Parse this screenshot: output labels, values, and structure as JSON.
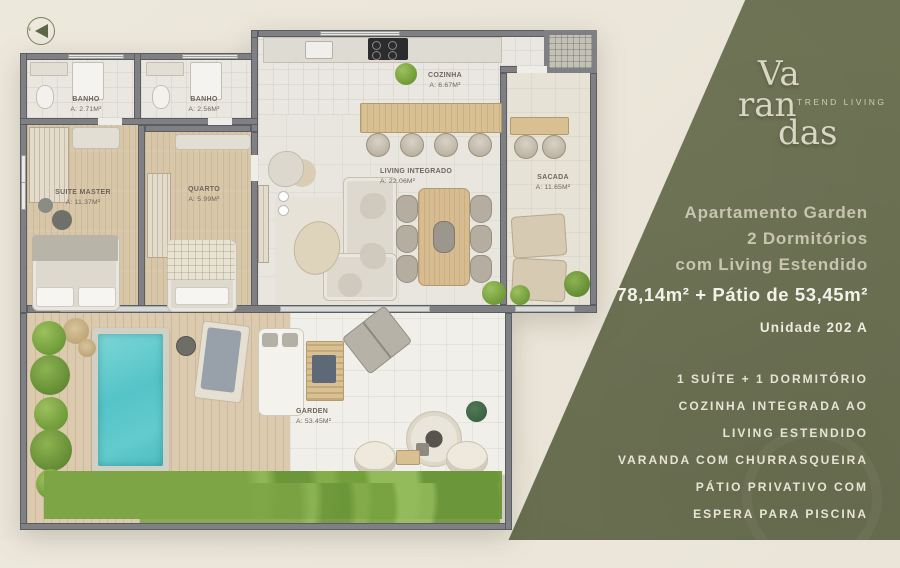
{
  "compass": {
    "north_label": "N"
  },
  "brand": {
    "line1": "Va",
    "line2": "ran",
    "line3": "das",
    "tagline": "TREND LIVING"
  },
  "panel": {
    "headline_line1": "Apartamento Garden",
    "headline_line2": "2 Dormitórios",
    "headline_line3": "com Living Estendido",
    "area_line": "78,14m² + Pátio de 53,45m²",
    "unit": "Unidade 202 A",
    "features": {
      "f1": "1 SUÍTE + 1 DORMITÓRIO",
      "f2": "COZINHA INTEGRADA AO",
      "f3": "LIVING ESTENDIDO",
      "f4": "VARANDA COM CHURRASQUEIRA",
      "f5": "PÁTIO PRIVATIVO COM",
      "f6": "ESPERA PARA PISCINA"
    },
    "colors": {
      "panel_green": "#6d7253",
      "area_text": "#f3f2ea",
      "headline_text": "#c7c4b0"
    }
  },
  "floorplan": {
    "rooms": [
      {
        "id": "banho1",
        "name": "BANHO",
        "area": "A: 2.71m²"
      },
      {
        "id": "banho2",
        "name": "BANHO",
        "area": "A: 2.56m²"
      },
      {
        "id": "suite",
        "name": "SUITE MASTER",
        "area": "A: 11.37m²"
      },
      {
        "id": "quarto",
        "name": "QUARTO",
        "area": "A: 5.99m²"
      },
      {
        "id": "cozinha",
        "name": "COZINHA",
        "area": "A: 6.67m²"
      },
      {
        "id": "living",
        "name": "LIVING INTEGRADO",
        "area": "A: 22.06m²"
      },
      {
        "id": "sacada",
        "name": "SACADA",
        "area": "A: 11.65m²"
      },
      {
        "id": "garden",
        "name": "GARDEN",
        "area": "A: 53.45m²"
      }
    ],
    "colors": {
      "wall": "#7e8083",
      "wood": "#d8c6a8",
      "tile": "#eae7e1",
      "pool_water": "#58c6ca",
      "plant": "#84ab4b"
    }
  }
}
